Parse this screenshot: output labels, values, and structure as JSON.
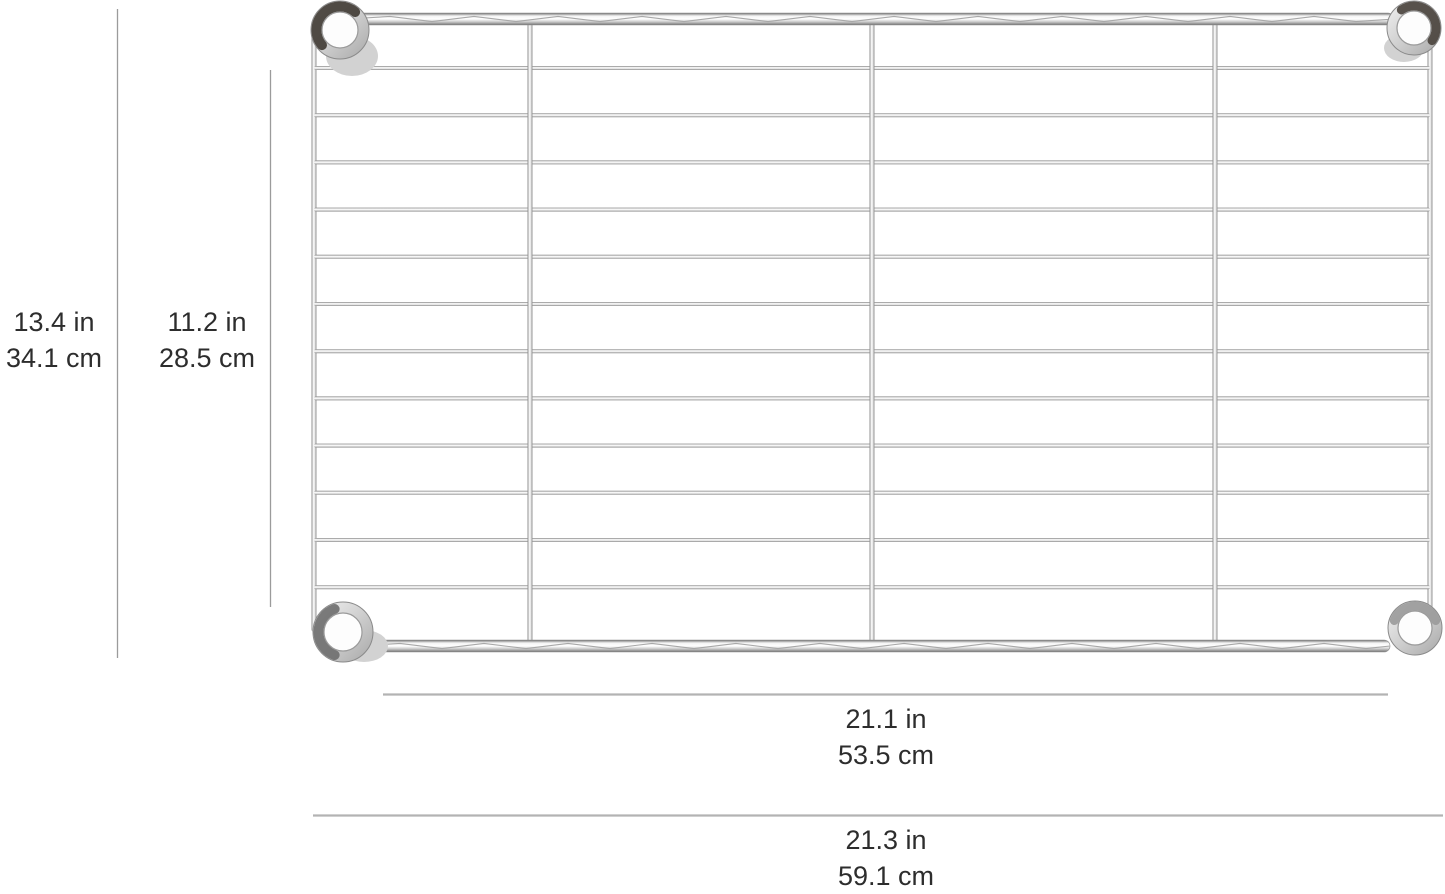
{
  "page": {
    "background": "#ffffff"
  },
  "product": {
    "type": "wire shelf",
    "finish": "chrome"
  },
  "dimensions": {
    "height_outer": {
      "in": "13.4 in",
      "cm": "34.1 cm"
    },
    "height_inner": {
      "in": "11.2 in",
      "cm": "28.5 cm"
    },
    "width_inner": {
      "in": "21.1 in",
      "cm": "53.5 cm"
    },
    "width_outer": {
      "in": "21.3 in",
      "cm": "59.1 cm"
    }
  },
  "shelf": {
    "horizontal_wire_count": 12,
    "vertical_rail_count": 3,
    "corner_collar_count": 4
  },
  "colors": {
    "chrome_highlight": "#ffffff",
    "chrome_mid": "#c9c9c9",
    "chrome_shadow": "#7f7f7f",
    "collar_dark": "#3f3a33",
    "dimension_line_light": "#b3b3b3",
    "dimension_line": "#9b9b9b",
    "label_text": "#2d2d2d"
  }
}
